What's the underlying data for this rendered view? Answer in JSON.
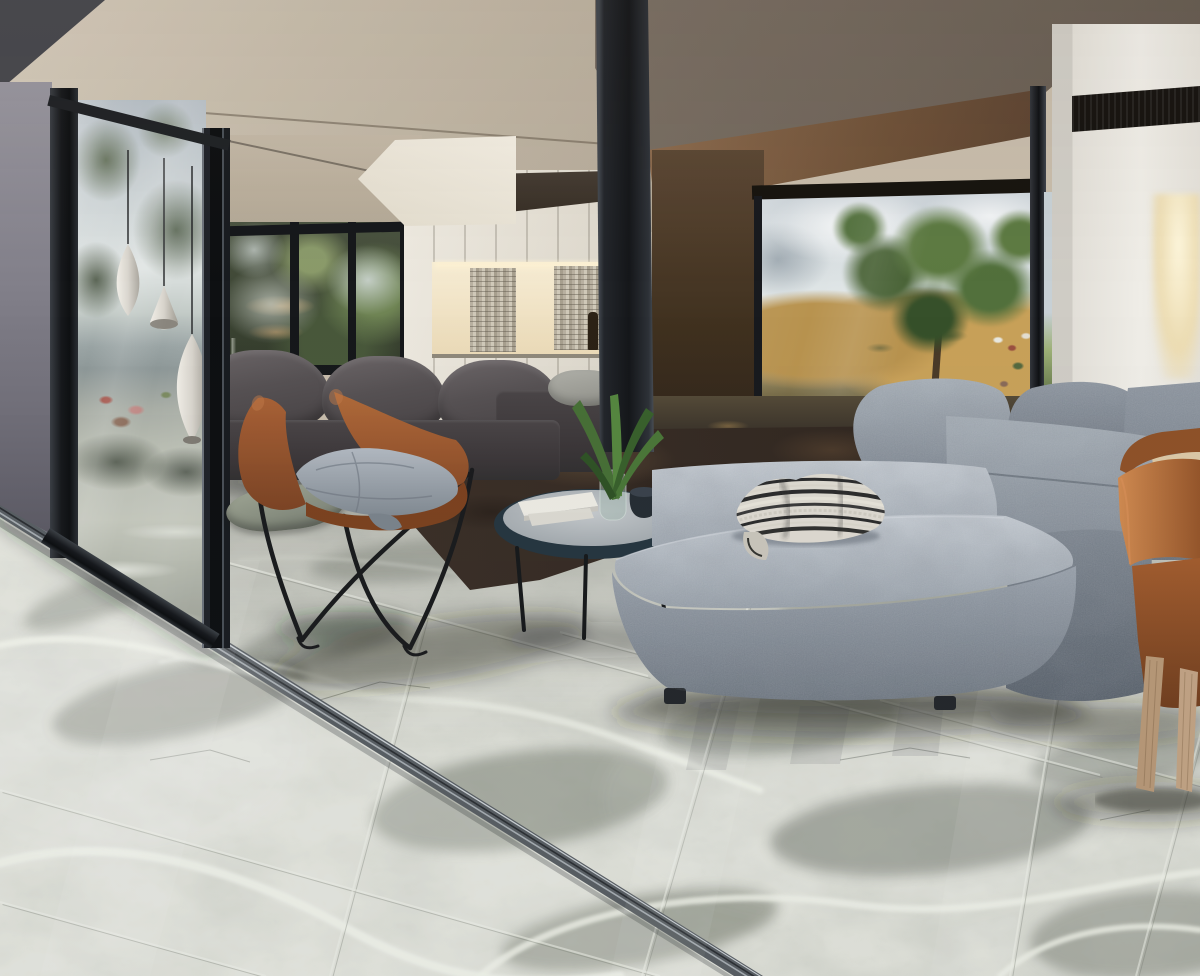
{
  "scene": {
    "type": "interior-architectural-render",
    "room": "Modern open-plan living room with polished grey onyx marble tile floor, glass sliding walls and hillside view",
    "time_of_day": "daytime",
    "palette": {
      "marble_light": "#e2e3db",
      "marble_grey": "#7d8177",
      "marble_vein_white": "#f0f2e9",
      "ceiling_beige": "#c7bcab",
      "ceiling_taupe": "#6e635a",
      "bronze_soffit": "#8a684c",
      "frame_black": "#17191c",
      "track_metal": "#9ea4a9",
      "glass_sky": "#c6ced6",
      "foliage_green": "#55703f",
      "hill_gold": "#c09a55",
      "cabinet_white": "#e9e5dc",
      "niche_warm_light": "#f6ecd2",
      "charcoal_sofa": "#4c4749",
      "grey_sectional": "#9aa2ac",
      "leather_cognac": "#a35f33",
      "chair_cushion_grey": "#9aa3ab",
      "terracotta_chair": "#b06a38",
      "wood_leg_tan": "#b89877",
      "wood_table": "#dbc8a6",
      "rug_brown": "#372c24",
      "throw_stripe_dark": "#2c2c2c",
      "throw_stripe_light": "#d8d4ca"
    },
    "objects": [
      {
        "id": 0,
        "label": "glossy grey onyx marble tile floor with white veining and diagonal sliding-door track"
      },
      {
        "id": 1,
        "label": "black-framed glass sliding wall with reflections of trees, sky, village and floor"
      },
      {
        "id": 2,
        "label": "cognac leather butterfly chair with grey cushion and black wire frame"
      },
      {
        "id": 3,
        "label": "charcoal fabric sofa in front of garden windows"
      },
      {
        "id": 4,
        "label": "round coffee table with books, glass vase with palm leaves and dark cup"
      },
      {
        "id": 5,
        "label": "large grey suede sectional sofa with ottoman and striped throw blanket"
      },
      {
        "id": 6,
        "label": "white cabinet wall with warm lit mosaic niche and bottles"
      },
      {
        "id": 7,
        "label": "glass corner with view of golden hills, large green tree and distant village"
      },
      {
        "id": 8,
        "label": "white column with black vent slot and warm lit recess"
      },
      {
        "id": 9,
        "label": "terracotta leather dining chairs with tan wood legs and light wood table"
      },
      {
        "id": 10,
        "label": "dark brown area rug"
      },
      {
        "id": 11,
        "label": "silver teardrop pendant lamps reflected in glass"
      },
      {
        "id": 12,
        "label": "beige angular ceiling planes and dark taupe ceiling with bronze soffit"
      },
      {
        "id": 13,
        "label": "sage floor cushion"
      }
    ]
  }
}
